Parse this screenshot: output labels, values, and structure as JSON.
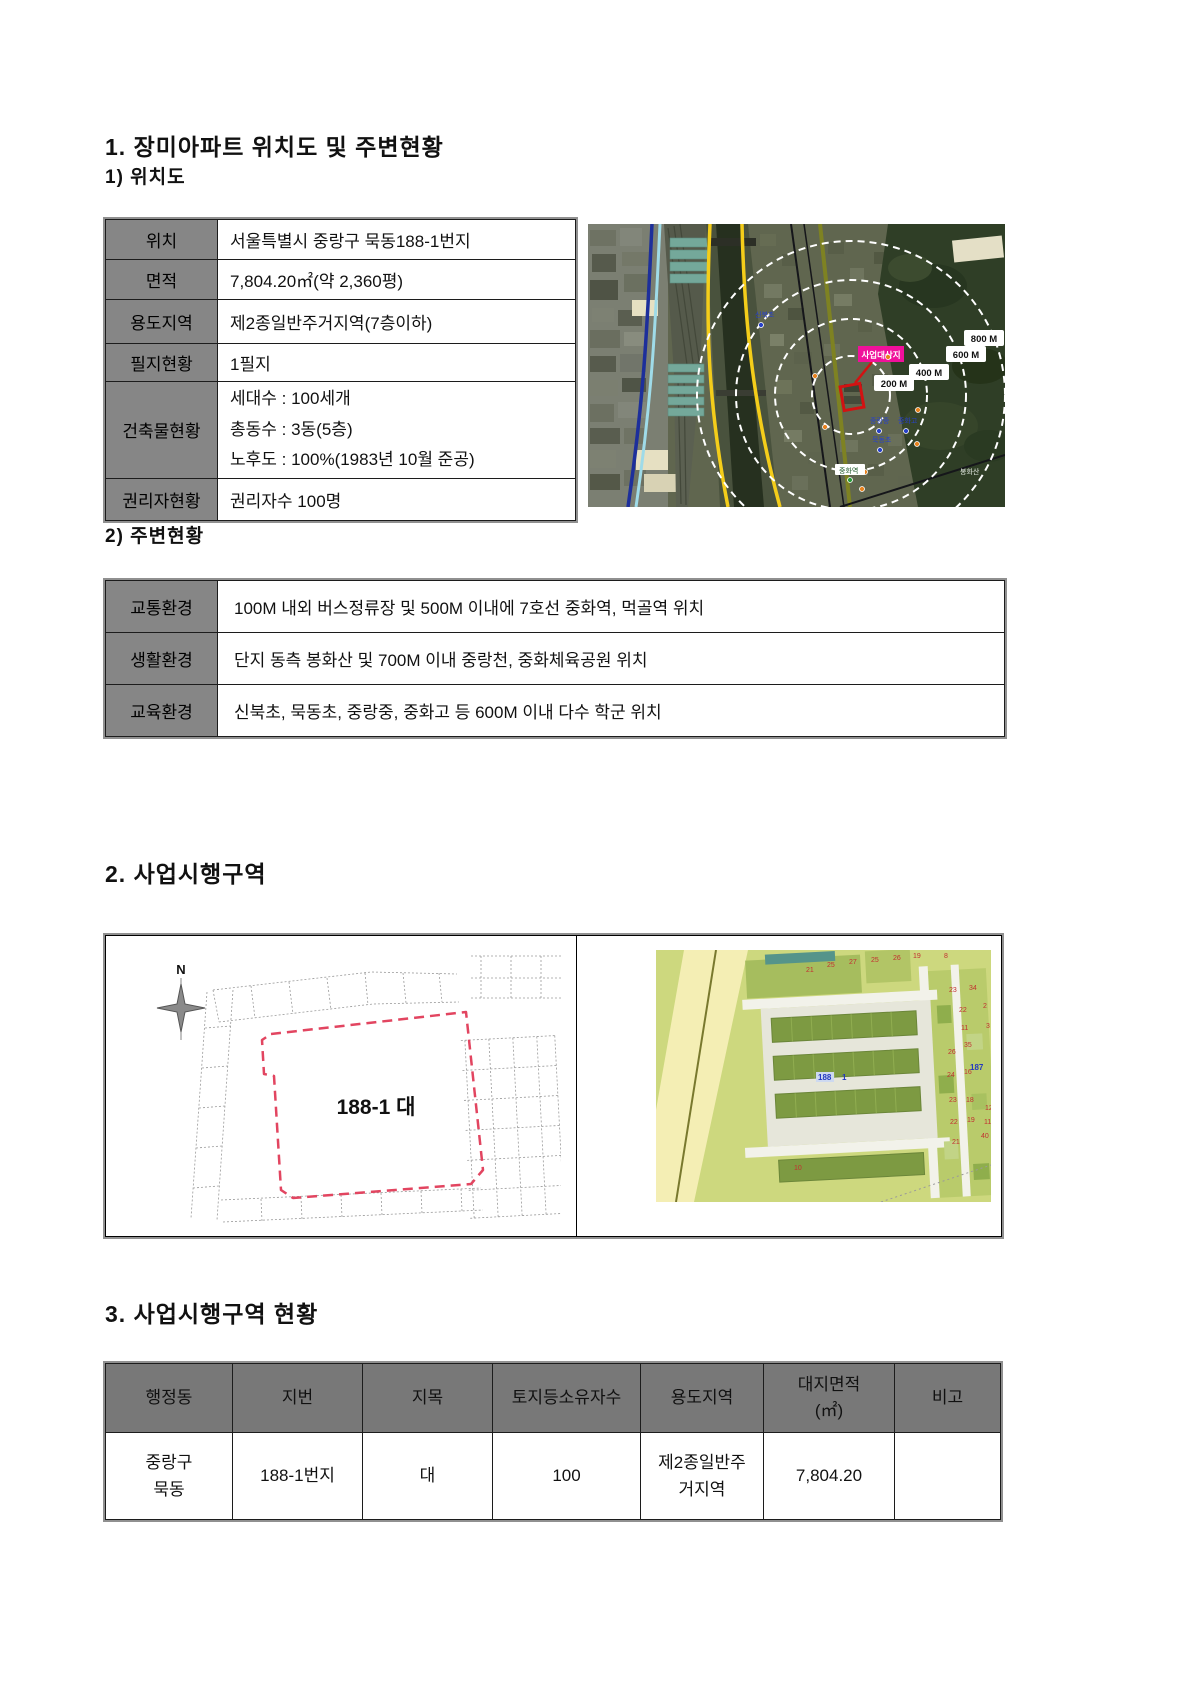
{
  "section1": {
    "heading": "1. 장미아파트 위치도 및 주변현황",
    "location": {
      "heading": "1) 위치도",
      "table": {
        "rows": [
          {
            "label": "위치",
            "value": "서울특별시 중랑구 묵동188-1번지"
          },
          {
            "label": "면적",
            "value": "7,804.20㎡(약 2,360평)"
          },
          {
            "label": "용도지역",
            "value": "제2종일반주거지역(7층이하)"
          },
          {
            "label": "필지현황",
            "value": "1필지"
          },
          {
            "label": "건축물현황",
            "value": "세대수 : 100세개\n총동수 : 3동(5층)\n노후도 : 100%(1983년 10월 준공)"
          },
          {
            "label": "권리자현황",
            "value": "권리자수 100명"
          }
        ]
      },
      "map": {
        "site_label": "사업대상지",
        "rings": [
          "200 M",
          "400 M",
          "600 M",
          "800 M"
        ],
        "pois": {
          "school1": "신북초",
          "school2": "중랑중",
          "school3": "중화고",
          "school4": "묵동초",
          "station": "중화역",
          "mountain": "봉화산"
        },
        "colors": {
          "site_box": "#f0109b",
          "site_outline": "#d21212",
          "ring": "#ffffff"
        }
      }
    },
    "surroundings": {
      "heading": "2) 주변현황",
      "table": {
        "rows": [
          {
            "label": "교통환경",
            "value": "100M 내외 버스정류장 및 500M 이내에 7호선 중화역, 먹골역 위치"
          },
          {
            "label": "생활환경",
            "value": "단지 동측 봉화산 및 700M 이내 중랑천, 중화체육공원 위치"
          },
          {
            "label": "교육환경",
            "value": "신북초, 묵동초, 중랑중, 중화고 등 600M 이내 다수 학군 위치"
          }
        ]
      }
    }
  },
  "section2": {
    "heading": "2. 사업시행구역",
    "cadastral": {
      "north": "N",
      "parcel": "188-1 대",
      "boundary_color": "#e24560"
    },
    "landuse": {
      "blue_labels": [
        "188",
        "1",
        "187"
      ],
      "red_numbers": [
        "21",
        "25",
        "27",
        "25",
        "26",
        "19",
        "8",
        "23",
        "34",
        "22",
        "2",
        "3",
        "11",
        "35",
        "26",
        "24",
        "16",
        "23",
        "18",
        "12",
        "22",
        "19",
        "11",
        "21",
        "40",
        "10"
      ]
    }
  },
  "section3": {
    "heading": "3. 사업시행구역 현황",
    "table": {
      "headers": [
        "행정동",
        "지번",
        "지목",
        "토지등소유자수",
        "용도지역",
        "대지면적\n(㎡)",
        "비고"
      ],
      "row": [
        "중랑구\n묵동",
        "188-1번지",
        "대",
        "100",
        "제2종일반주\n거지역",
        "7,804.20",
        ""
      ]
    }
  }
}
